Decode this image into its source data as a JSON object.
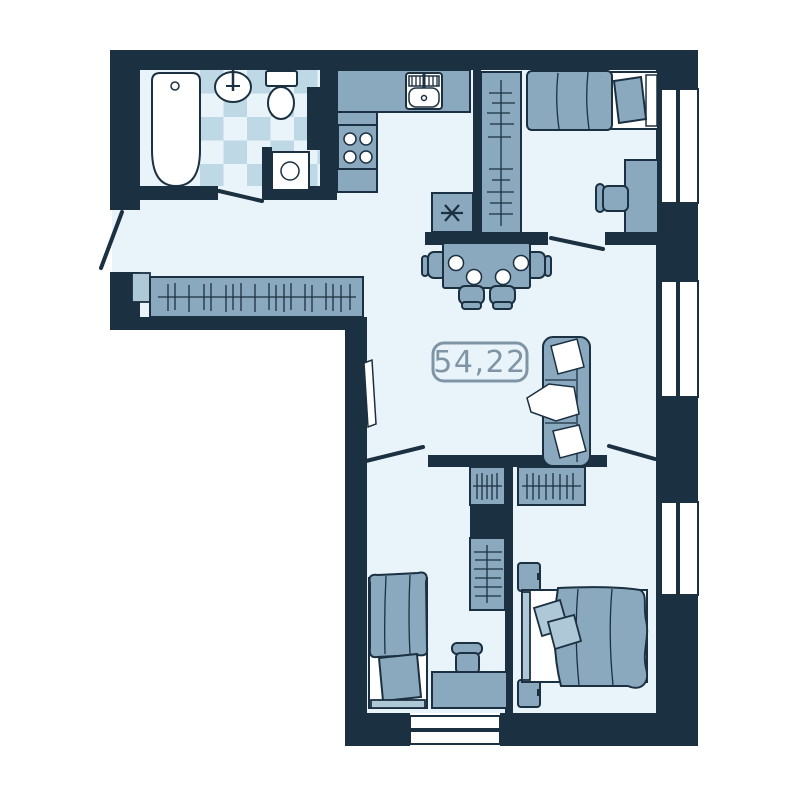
{
  "plan": {
    "title": "apartment-floor-plan",
    "area_label": "54,22",
    "colors": {
      "wall": "#1b3040",
      "floor": "#e9f4fa",
      "furniture": "#8aa8be",
      "furniture_light": "#aec8d8",
      "tile": "#bfd8e5",
      "white": "#ffffff",
      "label": "#7f95a5"
    },
    "rooms": [
      {
        "name": "bathroom",
        "furniture": [
          "bathtub-icon",
          "washbasin-icon",
          "toilet-icon",
          "washing-machine-icon"
        ]
      },
      {
        "name": "kitchen",
        "furniture": [
          "kitchen-counter-icon",
          "kitchen-sink-icon",
          "stove-icon",
          "fridge-icon"
        ]
      },
      {
        "name": "hallway",
        "furniture": [
          "wardrobe-icon"
        ]
      },
      {
        "name": "bedroom-top",
        "furniture": [
          "wardrobe-icon",
          "bed-icon",
          "desk-icon",
          "chair-icon"
        ]
      },
      {
        "name": "living-dining",
        "furniture": [
          "dining-table-icon",
          "chair-icon",
          "sofa-icon"
        ]
      },
      {
        "name": "bedroom-bottom-left",
        "furniture": [
          "wardrobe-icon",
          "bed-icon",
          "desk-icon",
          "chair-icon"
        ]
      },
      {
        "name": "bedroom-bottom-right",
        "furniture": [
          "wardrobe-icon",
          "double-bed-icon",
          "nightstand-icon"
        ]
      }
    ],
    "window_count": 4,
    "door_count": 5
  }
}
